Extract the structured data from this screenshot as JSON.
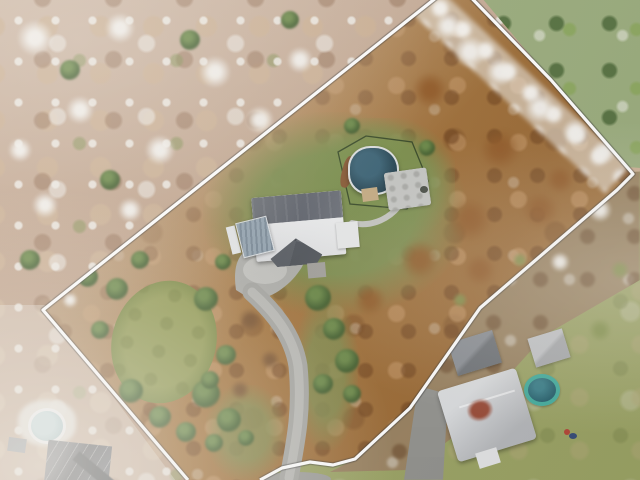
{
  "meta": {
    "type": "aerial-drone-photograph",
    "subject": "Overhead view of a wooded residential lot outlined with a white property-boundary line, late autumn with light snow dusting"
  },
  "colors": {
    "forestBase": "#c2a48c",
    "neConifer": "#7b9454",
    "brush": "#a5763f",
    "interiorGrass": "#7e9052",
    "lawn": "#949c56",
    "driveway": "#a6a6a2",
    "drivewayLight": "#c2c2be",
    "roofDark": "#6e7278",
    "roofWhite": "#eceded",
    "carport": "#8fa0ac",
    "poolCover": "#2c4a58",
    "poolSheen": "#3f6678",
    "poolRim": "#dde0e1",
    "woodDeck": "#8a5c38",
    "patio": "#c6c7c4",
    "neighborLawn": "#9aa264",
    "poolRing": "#44ad9e",
    "poolInner": "#26606d",
    "redRoofPatch": "#9b4e3a",
    "hazePool": "#cfe0e2",
    "hazeRoof": "#6f7073",
    "boundary": "#ffffff"
  },
  "boundary": {
    "points": "188,480 43,310 456,-18 551,80 627,167 633,174 617,190 559,240 480,308 410,408 355,459 333,465 310,462 282,468 260,480",
    "stroke_width": 3.2
  },
  "driveway": {
    "main_path": "M289,478 C297,436 302,408 298,366 C293,334 272,310 252,292",
    "apron_path": "M236,290 C232,262 240,248 262,244 L300,248 C306,252 306,262 300,270 C288,288 268,300 252,300 Z",
    "walkway_path": "M399,206 C387,221 369,227 352,223"
  },
  "pool_fence": {
    "points": "338,152 366,136 412,142 428,181 407,209 350,204"
  },
  "features": {
    "main_house": "main house with gray and white hip roof",
    "carport": "detached carport with ribbed metal roof",
    "pool": "above-ground pool with dark winter cover",
    "patio": "pool-side concrete patio",
    "driveway": "gravel driveway to road",
    "lawn_oval": "oval front lawn clearing",
    "neighbor_right": "neighboring house with trampoline pool",
    "neighbor_left": "neighboring house with round pool",
    "boundary": "white property boundary outline"
  },
  "blobs": [
    {
      "layer": "base",
      "type": "snow",
      "x": 35,
      "y": 38,
      "r": 18
    },
    {
      "layer": "base",
      "type": "snow",
      "x": 120,
      "y": 28,
      "r": 15
    },
    {
      "layer": "base",
      "type": "snow",
      "x": 215,
      "y": 72,
      "r": 16
    },
    {
      "layer": "base",
      "type": "snow",
      "x": 80,
      "y": 110,
      "r": 14
    },
    {
      "layer": "base",
      "type": "snow",
      "x": 160,
      "y": 150,
      "r": 15
    },
    {
      "layer": "base",
      "type": "snow",
      "x": 45,
      "y": 205,
      "r": 13
    },
    {
      "layer": "base",
      "type": "snow",
      "x": 260,
      "y": 120,
      "r": 14
    },
    {
      "layer": "base",
      "type": "snow",
      "x": 300,
      "y": 60,
      "r": 13
    },
    {
      "layer": "base",
      "type": "snow",
      "x": 220,
      "y": 180,
      "r": 12
    },
    {
      "layer": "base",
      "type": "snow",
      "x": 130,
      "y": 210,
      "r": 12
    },
    {
      "layer": "base",
      "type": "snow",
      "x": 20,
      "y": 150,
      "r": 12
    },
    {
      "layer": "base",
      "type": "snow",
      "x": 310,
      "y": 210,
      "r": 11
    },
    {
      "layer": "base",
      "type": "conifer",
      "x": 190,
      "y": 40,
      "r": 10
    },
    {
      "layer": "base",
      "type": "conifer",
      "x": 70,
      "y": 70,
      "r": 10
    },
    {
      "layer": "base",
      "type": "conifer",
      "x": 250,
      "y": 160,
      "r": 9
    },
    {
      "layer": "base",
      "type": "conifer",
      "x": 110,
      "y": 180,
      "r": 10
    },
    {
      "layer": "base",
      "type": "conifer",
      "x": 290,
      "y": 20,
      "r": 9
    },
    {
      "layer": "base",
      "type": "conifer",
      "x": 30,
      "y": 260,
      "r": 10
    },
    {
      "layer": "interior",
      "type": "rust",
      "x": 430,
      "y": 90,
      "r": 18
    },
    {
      "layer": "interior",
      "type": "rust",
      "x": 500,
      "y": 150,
      "r": 20
    },
    {
      "layer": "interior",
      "type": "rust",
      "x": 470,
      "y": 220,
      "r": 22
    },
    {
      "layer": "interior",
      "type": "rust",
      "x": 540,
      "y": 210,
      "r": 18
    },
    {
      "layer": "interior",
      "type": "rust",
      "x": 420,
      "y": 260,
      "r": 20
    },
    {
      "layer": "interior",
      "type": "rust",
      "x": 370,
      "y": 300,
      "r": 16
    },
    {
      "layer": "interior",
      "type": "rust",
      "x": 480,
      "y": 270,
      "r": 16
    },
    {
      "layer": "interior",
      "type": "rust",
      "x": 560,
      "y": 180,
      "r": 14
    },
    {
      "layer": "interior",
      "type": "moss",
      "x": 520,
      "y": 260,
      "r": 8
    },
    {
      "layer": "interior",
      "type": "moss",
      "x": 460,
      "y": 300,
      "r": 8
    },
    {
      "layer": "interior",
      "type": "snow",
      "x": 448,
      "y": 26,
      "r": 13
    },
    {
      "layer": "interior",
      "type": "snow",
      "x": 470,
      "y": 52,
      "r": 16
    },
    {
      "layer": "interior",
      "type": "snow",
      "x": 500,
      "y": 72,
      "r": 14
    },
    {
      "layer": "interior",
      "type": "snow",
      "x": 540,
      "y": 108,
      "r": 15
    },
    {
      "layer": "interior",
      "type": "snow",
      "x": 575,
      "y": 132,
      "r": 13
    },
    {
      "layer": "interior",
      "type": "snow",
      "x": 604,
      "y": 152,
      "r": 12
    },
    {
      "layer": "interior",
      "type": "snow",
      "x": 274,
      "y": 215,
      "r": 6
    },
    {
      "layer": "interior",
      "type": "snow",
      "x": 272,
      "y": 232,
      "r": 7
    },
    {
      "layer": "interior",
      "type": "snow",
      "x": 278,
      "y": 246,
      "r": 6
    },
    {
      "layer": "interior",
      "type": "snow",
      "x": 70,
      "y": 300,
      "r": 8
    },
    {
      "layer": "interior",
      "type": "conifer",
      "x": 318,
      "y": 298,
      "r": 13
    },
    {
      "layer": "interior",
      "type": "conifer",
      "x": 334,
      "y": 329,
      "r": 11
    },
    {
      "layer": "interior",
      "type": "conifer",
      "x": 347,
      "y": 361,
      "r": 12
    },
    {
      "layer": "interior",
      "type": "conifer",
      "x": 323,
      "y": 384,
      "r": 10
    },
    {
      "layer": "interior",
      "type": "conifer",
      "x": 352,
      "y": 394,
      "r": 9
    },
    {
      "layer": "interior",
      "type": "conifer",
      "x": 206,
      "y": 394,
      "r": 14
    },
    {
      "layer": "interior",
      "type": "conifer",
      "x": 229,
      "y": 420,
      "r": 12
    },
    {
      "layer": "interior",
      "type": "conifer",
      "x": 186,
      "y": 432,
      "r": 10
    },
    {
      "layer": "interior",
      "type": "conifer",
      "x": 214,
      "y": 443,
      "r": 9
    },
    {
      "layer": "interior",
      "type": "conifer",
      "x": 246,
      "y": 438,
      "r": 8
    },
    {
      "layer": "interior",
      "type": "conifer",
      "x": 117,
      "y": 289,
      "r": 11
    },
    {
      "layer": "interior",
      "type": "conifer",
      "x": 206,
      "y": 299,
      "r": 12
    },
    {
      "layer": "interior",
      "type": "conifer",
      "x": 226,
      "y": 355,
      "r": 10
    },
    {
      "layer": "interior",
      "type": "conifer",
      "x": 131,
      "y": 391,
      "r": 12
    },
    {
      "layer": "interior",
      "type": "conifer",
      "x": 160,
      "y": 417,
      "r": 11
    },
    {
      "layer": "interior",
      "type": "conifer",
      "x": 100,
      "y": 330,
      "r": 9
    },
    {
      "layer": "interior",
      "type": "conifer",
      "x": 210,
      "y": 380,
      "r": 9
    },
    {
      "layer": "interior",
      "type": "conifer",
      "x": 88,
      "y": 277,
      "r": 10
    },
    {
      "layer": "interior",
      "type": "conifer",
      "x": 140,
      "y": 260,
      "r": 9
    },
    {
      "layer": "interior",
      "type": "conifer",
      "x": 223,
      "y": 262,
      "r": 8
    },
    {
      "layer": "interior",
      "type": "conifer",
      "x": 427,
      "y": 148,
      "r": 8
    },
    {
      "layer": "interior",
      "type": "conifer",
      "x": 352,
      "y": 126,
      "r": 8
    },
    {
      "layer": "interior",
      "type": "shrub",
      "x": 250,
      "y": 320,
      "r": 12
    },
    {
      "layer": "interior",
      "type": "shrub",
      "x": 270,
      "y": 360,
      "r": 10
    },
    {
      "layer": "interior",
      "type": "shrub",
      "x": 240,
      "y": 390,
      "r": 10
    },
    {
      "layer": "se",
      "type": "snow",
      "x": 600,
      "y": 210,
      "r": 12
    },
    {
      "layer": "se",
      "type": "snow",
      "x": 560,
      "y": 262,
      "r": 10
    },
    {
      "layer": "se",
      "type": "moss",
      "x": 600,
      "y": 330,
      "r": 12
    },
    {
      "layer": "se",
      "type": "moss",
      "x": 620,
      "y": 270,
      "r": 10
    }
  ]
}
